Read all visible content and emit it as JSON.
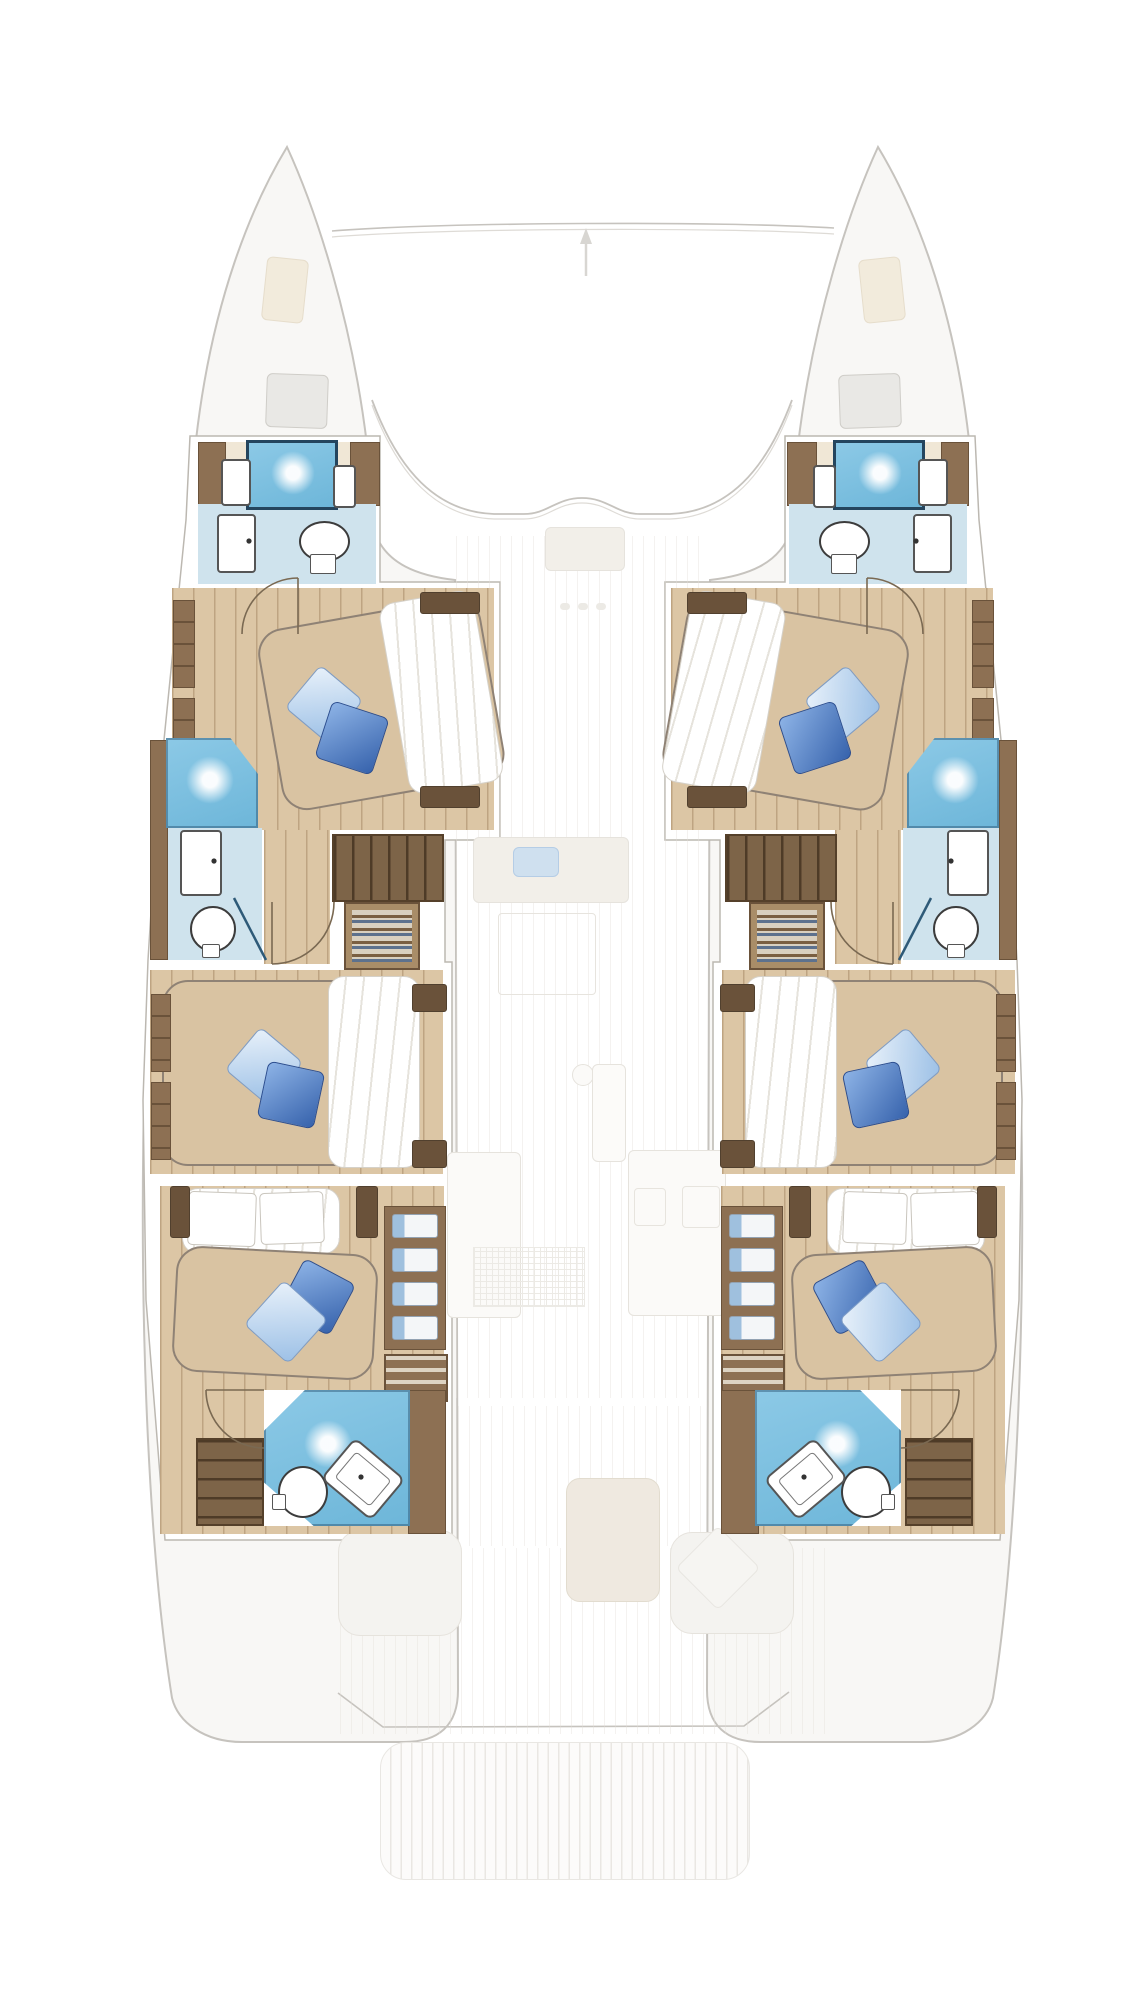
{
  "image": {
    "kind": "yacht-floor-plan",
    "view": "top-down catamaran lower-deck layout with ghosted main-deck overlay",
    "visible_text": []
  },
  "palette": {
    "bg": "#ffffff",
    "ghost-fill": "#f8f7f5",
    "ghost-line": "#c6c3be",
    "ghost-line-soft": "#dedbd6",
    "ghost-furniture": "#f2efe9",
    "wall-line": "#bcb8b1",
    "wood": "#8d7053",
    "wood-dark": "#6a523a",
    "wood-light": "#a98d68",
    "tread": "#55402a",
    "floor-plank": "#dcc6a5",
    "plank-line": "rgba(122,86,48,0.30)",
    "duvet": "#d9c3a2",
    "duvet-line": "#8f8275",
    "bath-floor": "#cfe3ed",
    "shower-blue-1": "#6db6d9",
    "shower-blue-2": "#8cc9e6",
    "shower-border": "#24455e",
    "pillow-dark-1": "#8db3e6",
    "pillow-dark-2": "#3662ac",
    "pillow-dark-border": "#2b4d8f",
    "pillow-light-1": "#e8f1fa",
    "pillow-light-2": "#9cc0e6",
    "pillow-light-border": "#7d9cc6",
    "towel-blue": "#9fc0de",
    "ghost-blue": "#cfe0ef"
  },
  "plan": {
    "hulls": [
      "port",
      "starboard"
    ],
    "cabins": [
      {
        "id": "port-forward-cabin",
        "bed": "double",
        "pillows": [
          "light-blue",
          "dark-blue"
        ]
      },
      {
        "id": "port-middle-cabin",
        "bed": "double",
        "pillows": [
          "light-blue",
          "dark-blue"
        ]
      },
      {
        "id": "port-aft-cabin",
        "bed": "double",
        "pillows": [
          "light-blue",
          "dark-blue"
        ]
      },
      {
        "id": "starboard-forward-cabin",
        "bed": "double",
        "pillows": [
          "light-blue",
          "dark-blue"
        ]
      },
      {
        "id": "starboard-middle-cabin",
        "bed": "double",
        "pillows": [
          "light-blue",
          "dark-blue"
        ]
      },
      {
        "id": "starboard-aft-cabin",
        "bed": "double",
        "pillows": [
          "light-blue",
          "dark-blue"
        ]
      }
    ],
    "bathrooms": [
      {
        "id": "port-forward-bathroom",
        "fixtures": [
          "shower",
          "toilet",
          "sink"
        ]
      },
      {
        "id": "port-middle-bathroom",
        "fixtures": [
          "shower",
          "toilet",
          "sink"
        ]
      },
      {
        "id": "port-aft-bathroom",
        "fixtures": [
          "shower",
          "toilet",
          "sink"
        ]
      },
      {
        "id": "starboard-forward-bathroom",
        "fixtures": [
          "shower",
          "toilet",
          "sink"
        ]
      },
      {
        "id": "starboard-middle-bathroom",
        "fixtures": [
          "shower",
          "toilet",
          "sink"
        ]
      },
      {
        "id": "starboard-aft-bathroom",
        "fixtures": [
          "shower",
          "toilet",
          "sink"
        ]
      }
    ],
    "stairs": [
      "port-companionway-stairs",
      "starboard-companionway-stairs",
      "port-aft-steps",
      "starboard-aft-steps"
    ],
    "ghosted_deck_elements": [
      "bow-trampoline-beam",
      "bow-deck-hatches",
      "anchor-lockers",
      "coachroof-front",
      "saloon-door",
      "nav-desk",
      "galley-counters",
      "galley-sinks",
      "mast-foot",
      "cockpit-table",
      "cockpit-seats",
      "cockpit-cushion",
      "transom-bench",
      "stern-platform"
    ]
  }
}
